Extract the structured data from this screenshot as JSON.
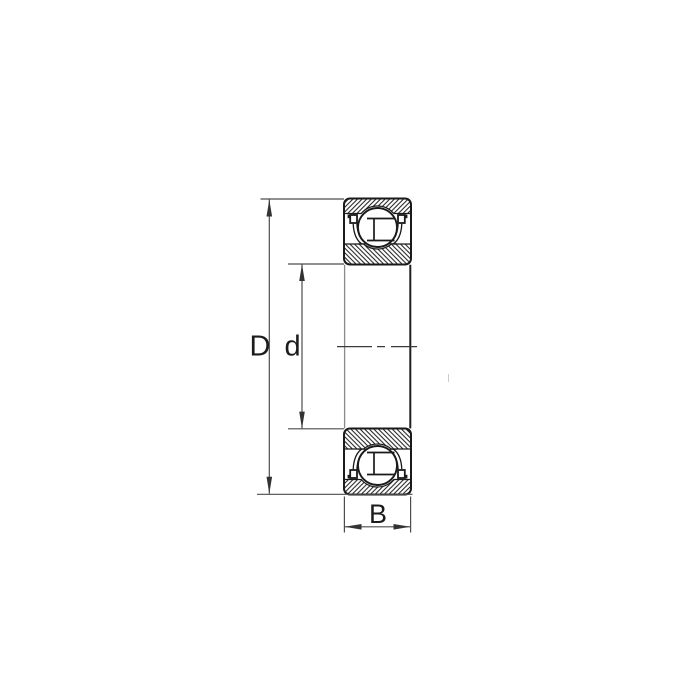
{
  "drawing": {
    "title": "ball-bearing-cross-section",
    "labels": {
      "outer_diameter": "D",
      "bore_diameter": "d",
      "width": "B"
    },
    "colors": {
      "outline": "#1a1a1a",
      "dimension_line": "#4d4d4d",
      "label_text": "#1b1b1b",
      "background": "#ffffff"
    }
  }
}
